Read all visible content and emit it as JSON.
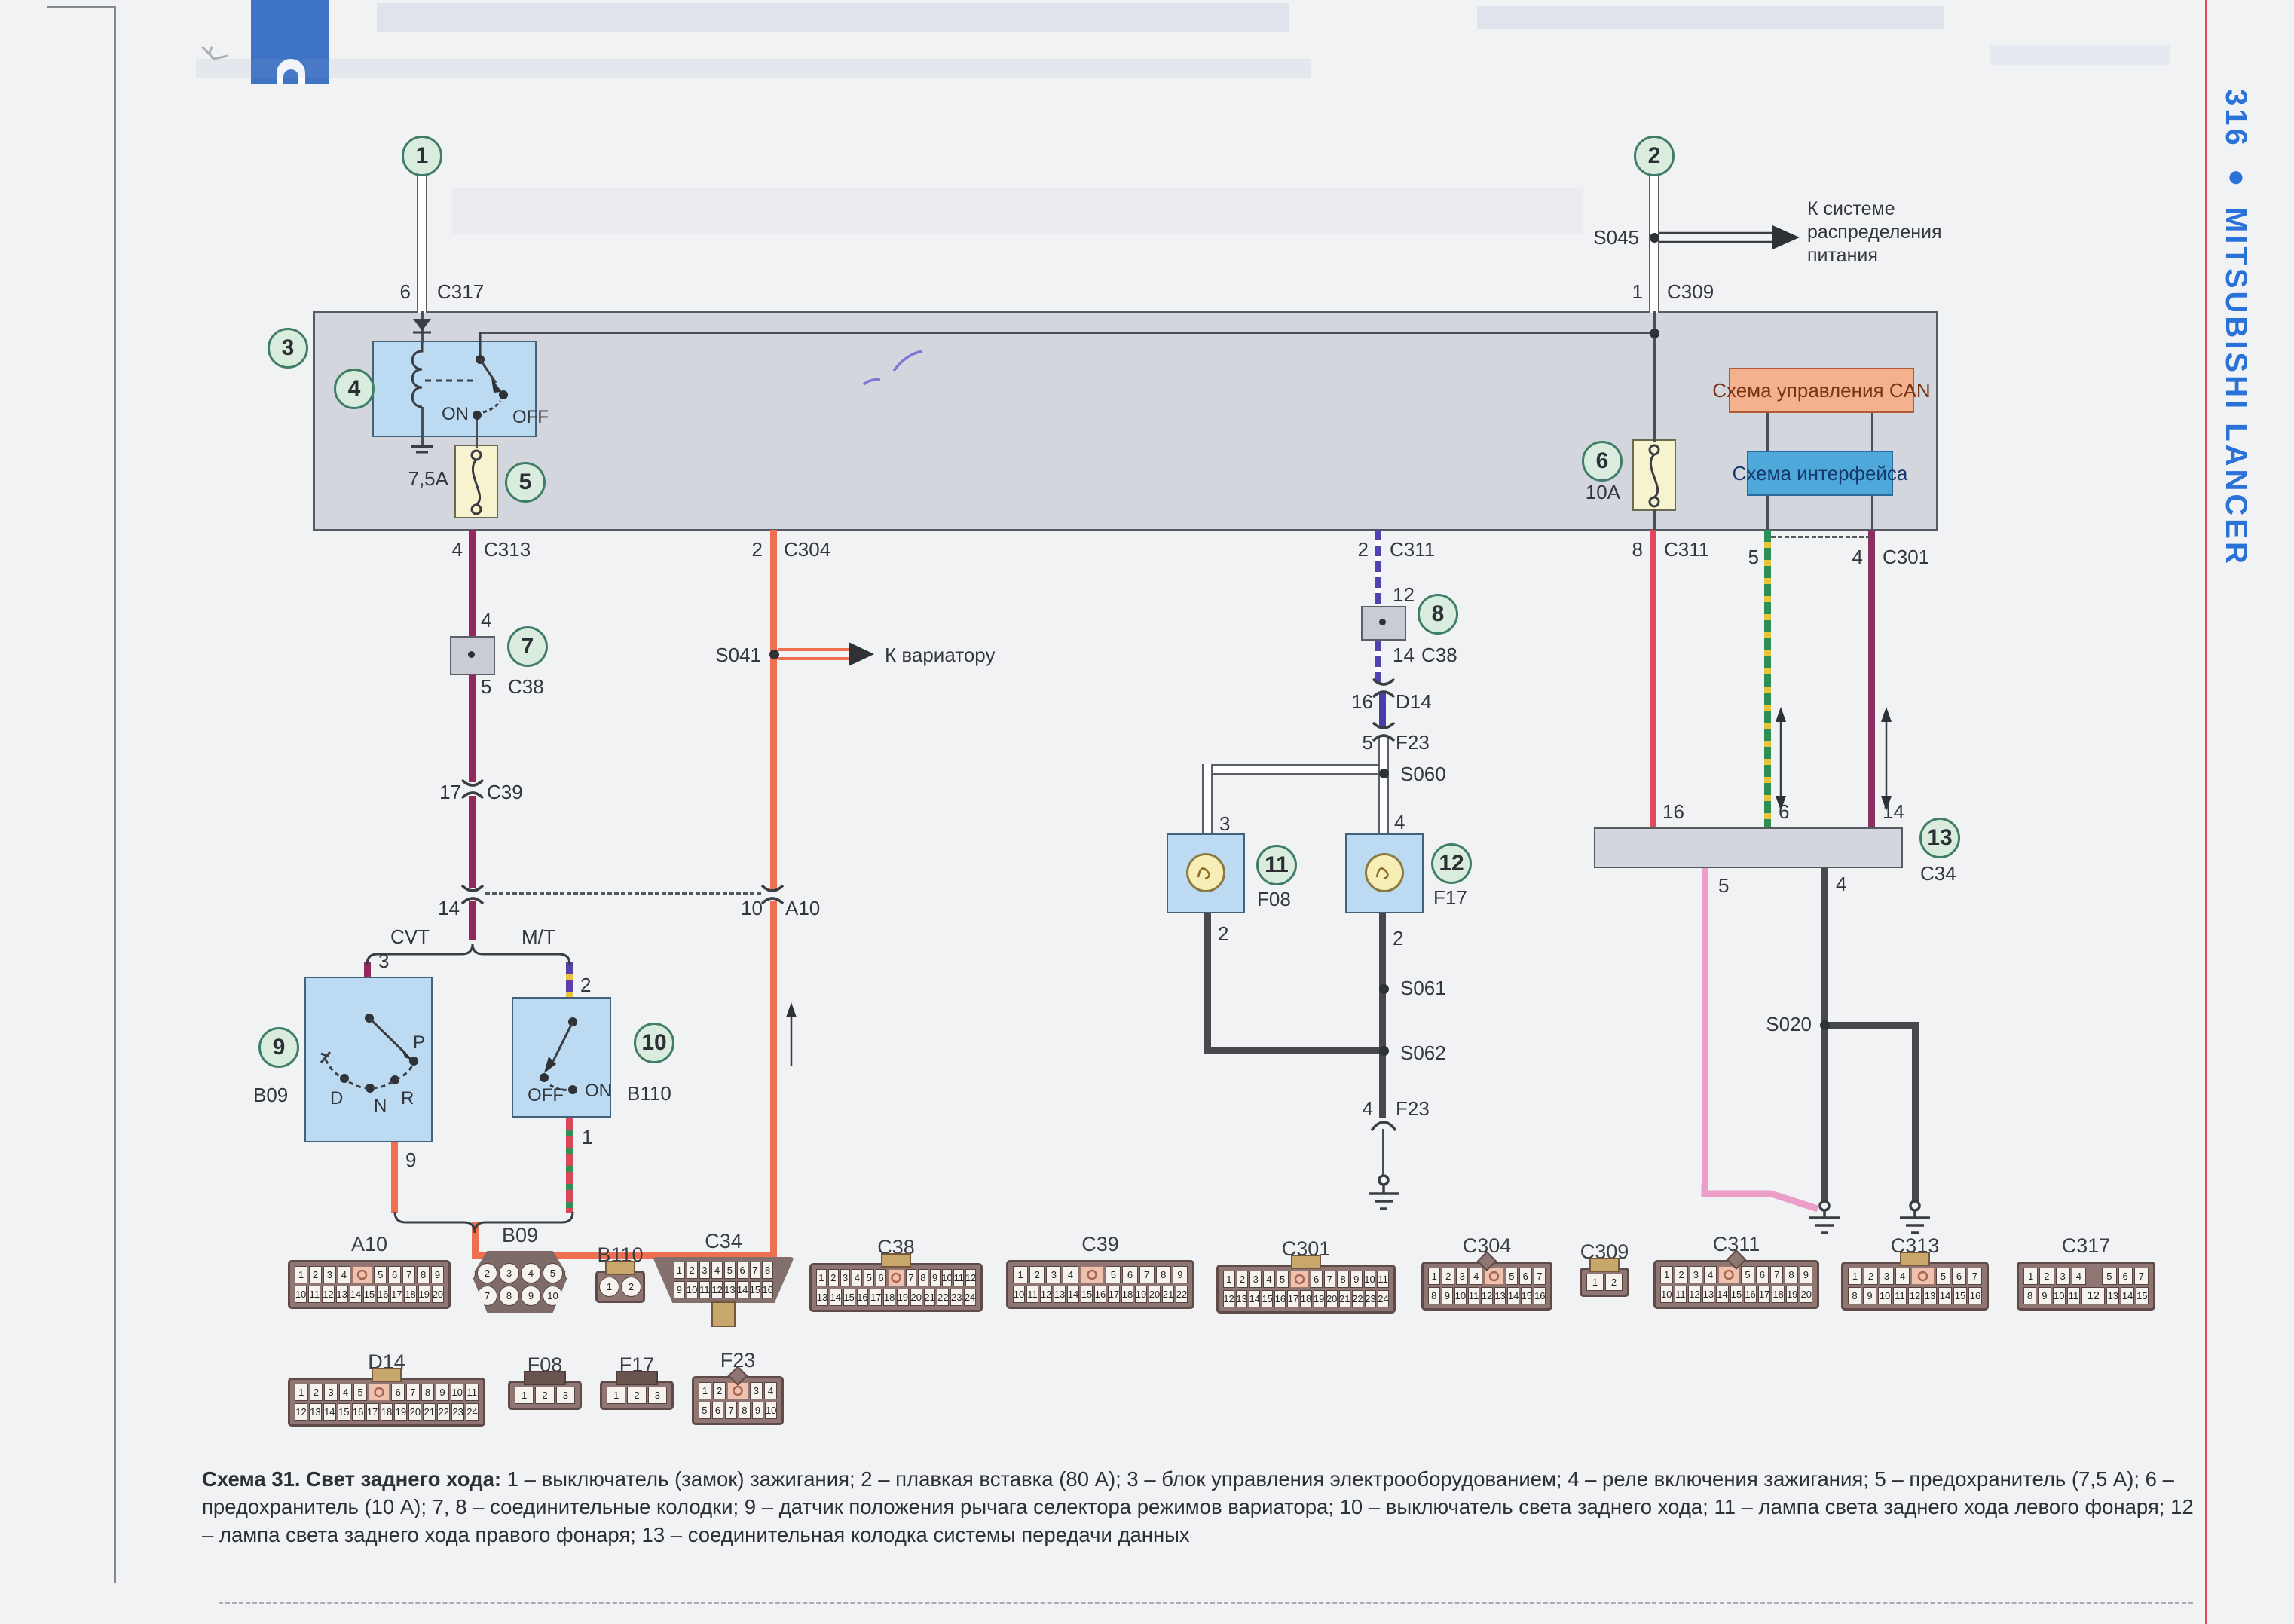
{
  "sidebar": {
    "page_marker": "316 ● MITSUBISHI LANCER"
  },
  "callouts": {
    "n1": "1",
    "n2": "2",
    "n3": "3",
    "n4": "4",
    "n5": "5",
    "n6": "6",
    "n7": "7",
    "n8": "8",
    "n9": "9",
    "n10": "10",
    "n11": "11",
    "n12": "12",
    "n13": "13"
  },
  "texts": {
    "to_power": "К системе распределения питания",
    "to_variator": "К вариатору",
    "cvt": "CVT",
    "mt": "M/T",
    "relay_on": "ON",
    "relay_off": "OFF",
    "b110_on": "ON",
    "b110_off": "OFF",
    "fuse5": "7,5A",
    "fuse6": "10A",
    "can_box": "Схема управления CAN",
    "interface_box": "Схема интерфейса",
    "pos_p": "P",
    "pos_r": "R",
    "pos_n": "N",
    "pos_d": "D"
  },
  "pins": {
    "c317_pin": "6",
    "c317_name": "C317",
    "c309_pin": "1",
    "c309_name": "C309",
    "c313_pin": "4",
    "c313_name": "C313",
    "c304_pin": "2",
    "c304_name": "C304",
    "c311a_pin": "2",
    "c311a_name": "C311",
    "c311b_pin": "8",
    "c311b_name": "C311",
    "c301_pin5": "5",
    "c301_pin4": "4",
    "c301_name": "C301",
    "c38a_top": "4",
    "c38a_bot": "5",
    "c38a_name": "C38",
    "c38b_top": "12",
    "c38b_bot": "14",
    "c38b_name": "C38",
    "c39_pin": "17",
    "c39_name": "C39",
    "a10_pin14": "14",
    "a10_pin10": "10",
    "a10_name": "A10",
    "b09_pin3": "3",
    "b09_pin9": "9",
    "b09_name": "B09",
    "b110_pin2": "2",
    "b110_pin1": "1",
    "b110_name": "B110",
    "d14_pin": "16",
    "d14_name": "D14",
    "f23a_pin": "5",
    "f23a_name": "F23",
    "f23b_pin": "4",
    "f23b_name": "F23",
    "f08_pin3": "3",
    "f08_pin2": "2",
    "f08_name": "F08",
    "f17_pin4": "4",
    "f17_pin2": "2",
    "f17_name": "F17",
    "c34_pin16": "16",
    "c34_pin6": "6",
    "c34_pin14": "14",
    "c34_pin5": "5",
    "c34_pin4": "4",
    "c34_name": "C34"
  },
  "splices": {
    "s041": "S041",
    "s045": "S045",
    "s020": "S020",
    "s060": "S060",
    "s061": "S061",
    "s062": "S062"
  },
  "caption": {
    "title": "Схема 31. Свет заднего хода:",
    "body": " 1 – выключатель (замок) зажигания; 2 – плавкая вставка (80 А); 3 – блок управления электрооборудованием; 4 – реле включения зажигания; 5 – предохранитель (7,5 А); 6 – предохранитель (10 А); 7, 8 – соединительные колодки; 9 – датчик положения рычага селектора режимов вариатора; 10 – выключатель света заднего хода; 11 – лампа света заднего хода левого фонаря; 12 – лампа света заднего хода правого фонаря; 13 – соединительная колодка системы передачи данных"
  },
  "colors": {
    "accent_blue": "#2b72d8",
    "edge_line_red": "#e8485a",
    "wire_red": "#e0485e",
    "wire_orange": "#ee7050",
    "wire_maroon": "#93285c",
    "wire_pink": "#ec9ec9",
    "wire_black": "#46484d",
    "wire_blue": "#4a3cac",
    "stripe_yellow": "#e8c43c",
    "stripe_green": "#2e8f56",
    "stripe_purple": "#5b3fa8",
    "callout_green": "#d9ecdd",
    "box_gray": "#d4d6de",
    "box_blue": "#bcdaf2",
    "can_orange": "#f4b18e",
    "interface_blue": "#4fa8da"
  },
  "connectors": [
    {
      "name": "A10",
      "shape": "std",
      "tab": "none",
      "rows": [
        [
          "1",
          "2",
          "3",
          "4",
          "§K",
          "5",
          "6",
          "7",
          "8",
          "9"
        ],
        [
          "10",
          "11",
          "12",
          "13",
          "14",
          "15",
          "16",
          "17",
          "18",
          "19",
          "20"
        ]
      ]
    },
    {
      "name": "B09",
      "shape": "hex",
      "tab": "none",
      "round": true,
      "rows": [
        [
          "1",
          "2",
          "3",
          "4",
          "5",
          "6"
        ],
        [
          "7",
          "8",
          "9",
          "10"
        ]
      ]
    },
    {
      "name": "B110",
      "shape": "std",
      "tab": "top",
      "round": true,
      "rows": [
        [
          "1",
          "2"
        ]
      ]
    },
    {
      "name": "C34",
      "shape": "trap",
      "tab": "bottom",
      "rows": [
        [
          "1",
          "2",
          "3",
          "4",
          "5",
          "6",
          "7",
          "8"
        ],
        [
          "9",
          "10",
          "11",
          "12",
          "13",
          "14",
          "15",
          "16"
        ]
      ]
    },
    {
      "name": "C38",
      "shape": "std",
      "tab": "top",
      "rows": [
        [
          "1",
          "2",
          "3",
          "4",
          "5",
          "6",
          "§K",
          "7",
          "8",
          "9",
          "10",
          "11",
          "12"
        ],
        [
          "13",
          "14",
          "15",
          "16",
          "17",
          "18",
          "19",
          "20",
          "21",
          "22",
          "23",
          "24"
        ]
      ]
    },
    {
      "name": "C39",
      "shape": "std",
      "tab": "none",
      "rows": [
        [
          "1",
          "2",
          "3",
          "4",
          "§K",
          "5",
          "6",
          "7",
          "8",
          "9"
        ],
        [
          "10",
          "11",
          "12",
          "13",
          "14",
          "15",
          "16",
          "17",
          "18",
          "19",
          "20",
          "21",
          "22"
        ]
      ]
    },
    {
      "name": "C301",
      "shape": "std",
      "tab": "top",
      "rows": [
        [
          "1",
          "2",
          "3",
          "4",
          "5",
          "§K",
          "6",
          "7",
          "8",
          "9",
          "10",
          "11"
        ],
        [
          "12",
          "13",
          "14",
          "15",
          "16",
          "17",
          "18",
          "19",
          "20",
          "21",
          "22",
          "23",
          "24"
        ]
      ]
    },
    {
      "name": "C304",
      "shape": "std",
      "tab": "diamond",
      "rows": [
        [
          "1",
          "2",
          "3",
          "4",
          "§K",
          "5",
          "6",
          "7"
        ],
        [
          "8",
          "9",
          "10",
          "11",
          "12",
          "13",
          "14",
          "15",
          "16"
        ]
      ]
    },
    {
      "name": "C309",
      "shape": "std",
      "tab": "top",
      "rows": [
        [
          "1",
          "2"
        ]
      ]
    },
    {
      "name": "C311",
      "shape": "std",
      "tab": "diamond",
      "rows": [
        [
          "1",
          "2",
          "3",
          "4",
          "§K",
          "5",
          "6",
          "7",
          "8",
          "9"
        ],
        [
          "10",
          "11",
          "12",
          "13",
          "14",
          "15",
          "16",
          "17",
          "18",
          "19",
          "20"
        ]
      ]
    },
    {
      "name": "C313",
      "shape": "std",
      "tab": "top",
      "rows": [
        [
          "1",
          "2",
          "3",
          "4",
          "§K",
          "5",
          "6",
          "7"
        ],
        [
          "8",
          "9",
          "10",
          "11",
          "12",
          "13",
          "14",
          "15",
          "16"
        ]
      ]
    },
    {
      "name": "C317",
      "shape": "std",
      "tab": "none",
      "rows": [
        [
          "1",
          "2",
          "3",
          "4",
          "§G",
          "5",
          "6",
          "7"
        ],
        [
          "8",
          "9",
          "10",
          "11",
          "§W12",
          "13",
          "14",
          "15"
        ]
      ]
    },
    {
      "name": "D14",
      "shape": "std",
      "tab": "top",
      "rows": [
        [
          "1",
          "2",
          "3",
          "4",
          "5",
          "§K",
          "6",
          "7",
          "8",
          "9",
          "10",
          "11"
        ],
        [
          "12",
          "13",
          "14",
          "15",
          "16",
          "17",
          "18",
          "19",
          "20",
          "21",
          "22",
          "23",
          "24"
        ]
      ]
    },
    {
      "name": "F08",
      "shape": "std",
      "tab": "topdark",
      "rows": [
        [
          "1",
          "2",
          "3"
        ]
      ]
    },
    {
      "name": "F17",
      "shape": "std",
      "tab": "topdark",
      "rows": [
        [
          "1",
          "2",
          "3"
        ]
      ]
    },
    {
      "name": "F23",
      "shape": "std",
      "tab": "diamond",
      "rows": [
        [
          "1",
          "2",
          "§K",
          "3",
          "4"
        ],
        [
          "5",
          "6",
          "7",
          "8",
          "9",
          "10"
        ]
      ]
    }
  ]
}
